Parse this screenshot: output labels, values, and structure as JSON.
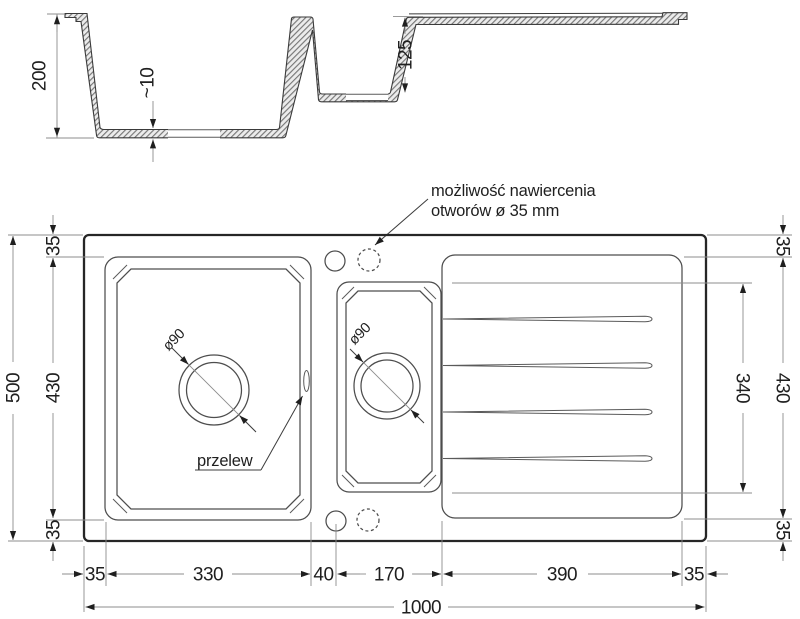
{
  "section": {
    "dim_total_height": "200",
    "dim_bottom_thickness": "~10",
    "dim_small_bowl_depth": "125"
  },
  "plan": {
    "left": {
      "dim_total": "500",
      "dim_top": "35",
      "dim_middle": "430",
      "dim_bottom": "35"
    },
    "right": {
      "dim_top": "35",
      "dim_middle": "430",
      "dim_bottom": "35",
      "dim_drainer": "340"
    },
    "bottom": {
      "dims": [
        "35",
        "330",
        "40",
        "170",
        "390",
        "35"
      ],
      "dim_total": "1000"
    },
    "drill_note_line1": "możliwość nawiercenia",
    "drill_note_line2": "otworów ø 35 mm",
    "overflow_label": "przelew",
    "main_drain_diameter": "ø90",
    "small_drain_diameter": "ø90"
  },
  "colors": {
    "outline_dark": "#262626",
    "feature_line": "#4d4d4d",
    "dimension_line": "#8c8c8c",
    "text": "#1f1f1f",
    "hatch_background": "#ececec"
  }
}
